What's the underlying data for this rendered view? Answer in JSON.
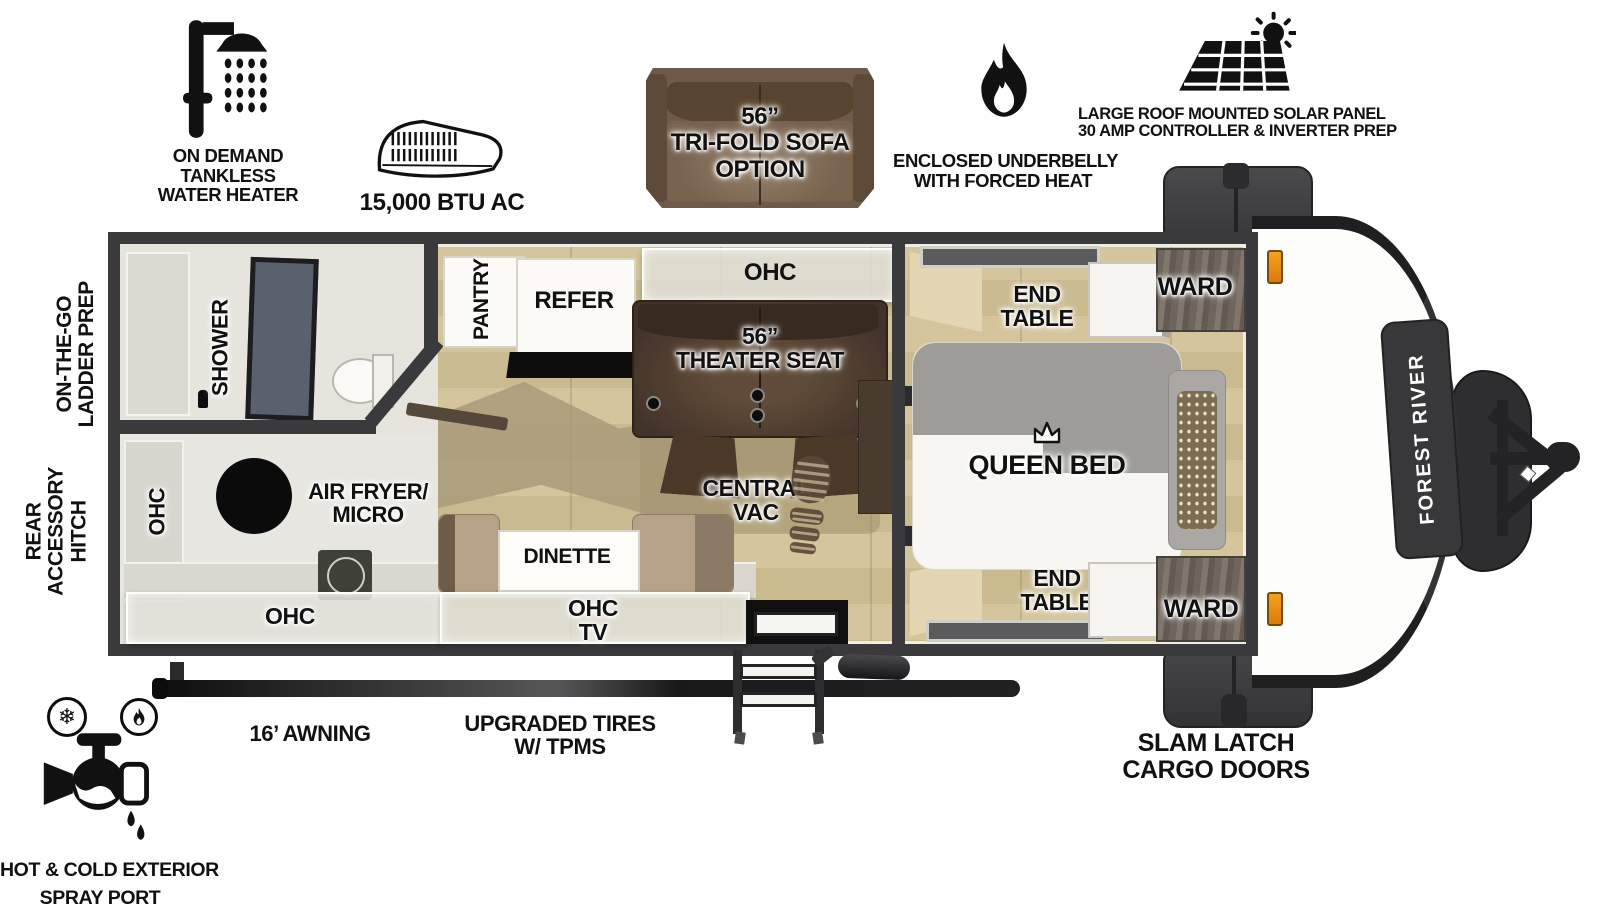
{
  "brand": {
    "name": "FOREST RIVER"
  },
  "icons": {
    "snowflake": "❄"
  },
  "callouts": {
    "water_heater": {
      "line1": "ON DEMAND",
      "line2": "TANKLESS",
      "line3": "WATER HEATER"
    },
    "ac": {
      "label": "15,000 BTU AC"
    },
    "sofa": {
      "line1": "56”",
      "line2": "TRI-FOLD SOFA",
      "line3": "OPTION"
    },
    "underbelly": {
      "line1": "ENCLOSED UNDERBELLY",
      "line2": "WITH FORCED HEAT"
    },
    "solar": {
      "line1": "LARGE ROOF MOUNTED SOLAR PANEL",
      "line2": "30 AMP CONTROLLER & INVERTER PREP"
    },
    "ladder": {
      "line1": "ON-THE-GO",
      "line2": "LADDER PREP"
    },
    "hitch": {
      "line1": "REAR",
      "line2": "ACCESSORY",
      "line3": "HITCH"
    },
    "awning": {
      "label": "16’ AWNING"
    },
    "tires": {
      "line1": "UPGRADED TIRES",
      "line2": "W/ TPMS"
    },
    "cargo": {
      "line1": "SLAM LATCH",
      "line2": "CARGO DOORS"
    },
    "spray": {
      "line1": "HOT & COLD EXTERIOR",
      "line2": "SPRAY PORT"
    }
  },
  "plan": {
    "shower": "SHOWER",
    "pantry": "PANTRY",
    "refer": "REFER",
    "ohc_galley": "OHC",
    "ohc_kitchen": "OHC",
    "ohc_counter": "OHC",
    "theater": {
      "line1": "56”",
      "line2": "THEATER SEAT"
    },
    "central_vac": {
      "line1": "CENTRAL",
      "line2": "VAC"
    },
    "air_fryer": {
      "line1": "AIR FRYER/",
      "line2": "MICRO"
    },
    "dinette": "DINETTE",
    "ohc_tv": {
      "line1": "OHC",
      "line2": "TV"
    },
    "queen_bed": "QUEEN BED",
    "end_table_top": {
      "line1": "END",
      "line2": "TABLE"
    },
    "end_table_bottom": {
      "line1": "END",
      "line2": "TABLE"
    },
    "ward_top": "WARD",
    "ward_bottom": "WARD"
  },
  "colors": {
    "wall": "#3a3a3c",
    "wood_floor": "#cfc099",
    "marker_light": "#e8891f",
    "theater_brown": "#42332a",
    "sofa_brown": "#6e5a49"
  }
}
